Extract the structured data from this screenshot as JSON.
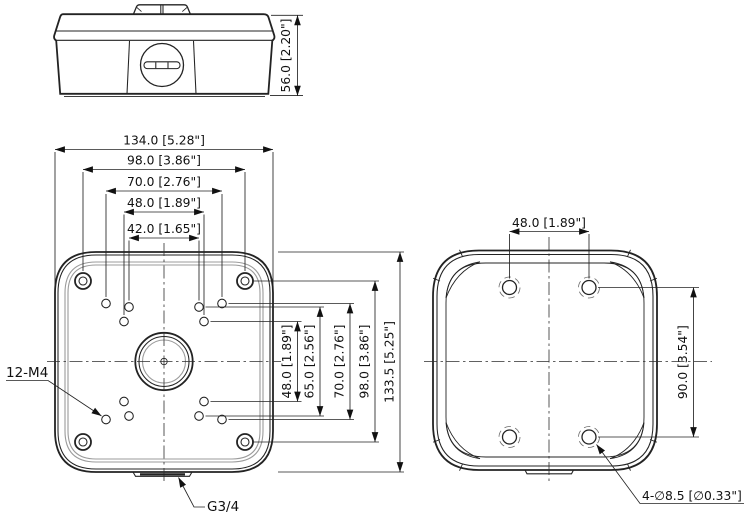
{
  "colors": {
    "line": "#232323",
    "secondary_line": "#9b9b9b",
    "background": "#ffffff"
  },
  "views": {
    "side": {
      "height_dim": "56.0 [2.20\"]"
    },
    "front": {
      "width_dims": [
        "134.0 [5.28\"]",
        "98.0 [3.86\"]",
        "70.0 [2.76\"]",
        "48.0 [1.89\"]",
        "42.0 [1.65\"]"
      ],
      "height_dims": [
        "48.0 [1.89\"]",
        "65.0 [2.56\"]",
        "70.0 [2.76\"]",
        "98.0 [3.86\"]",
        "133.5 [5.25\"]"
      ],
      "thread_label": "12-M4",
      "conduit_label": "G3/4"
    },
    "back": {
      "hole_spacing_horizontal": "48.0 [1.89\"]",
      "hole_spacing_vertical": "90.0 [3.54\"]",
      "mount_holes_label": "4-∅8.5 [∅0.33\"]"
    }
  }
}
